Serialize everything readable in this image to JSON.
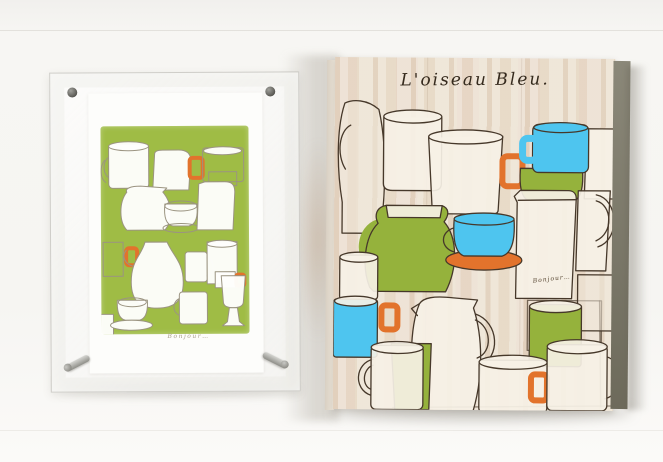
{
  "palette": {
    "blue": "#4ec5ef",
    "green": "#95b23c",
    "print_green": "#9fbc45",
    "orange": "#e2732c",
    "outline_dark": "#46382a",
    "outline_light": "#9b9481",
    "wood": "#e9dfd1",
    "panel_side": "#716e5f",
    "paper": "#fdfdfb",
    "background": "#f5f4f1"
  },
  "panel": {
    "title": "L'oiseau Bleu.",
    "signature": "Bonjour…"
  },
  "print": {
    "signature": "Bonjour…"
  }
}
